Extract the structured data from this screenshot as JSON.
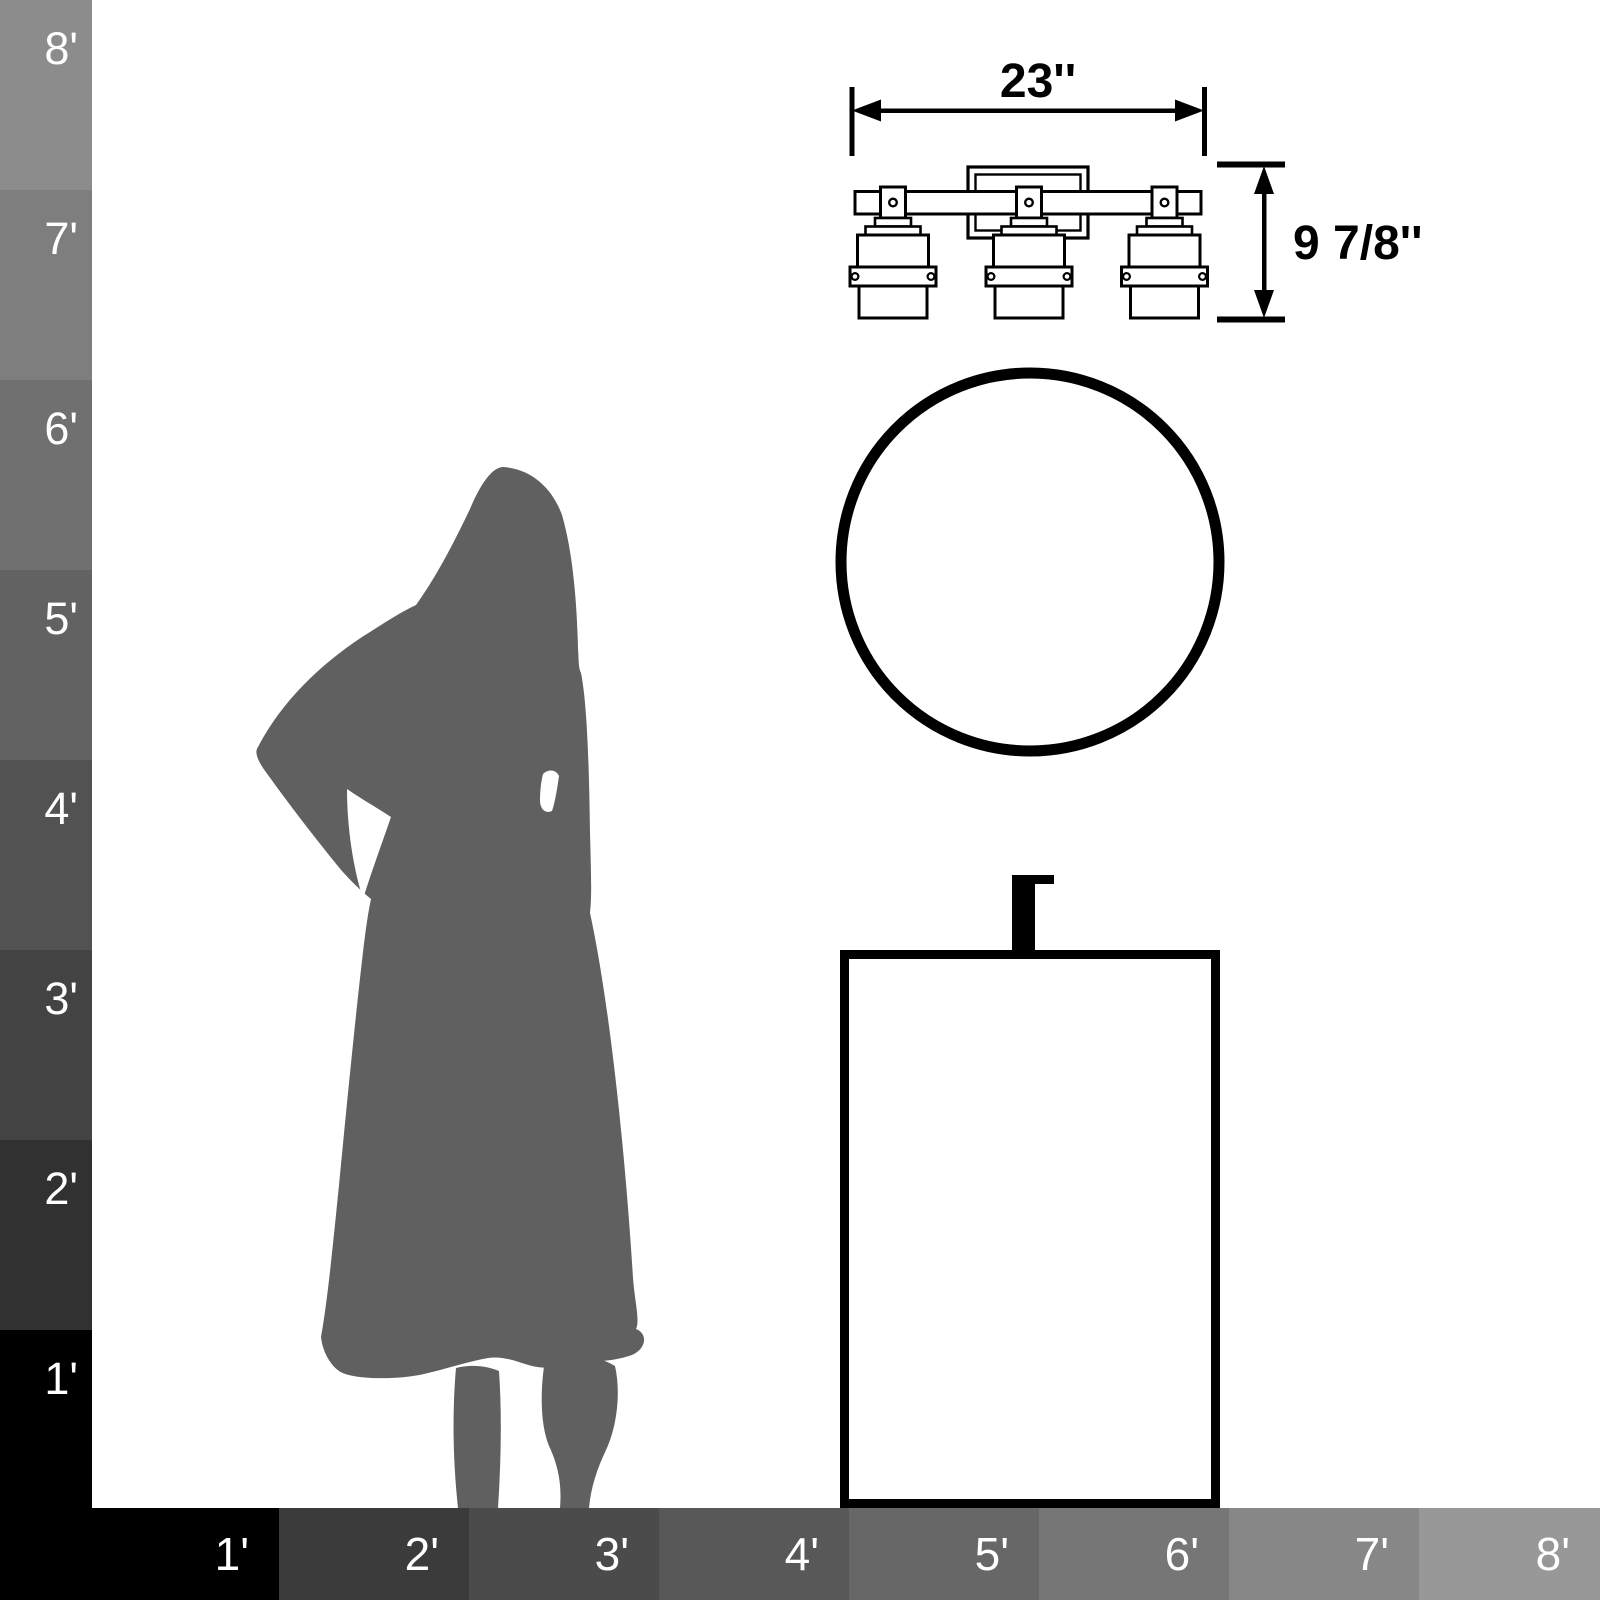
{
  "rulers": {
    "text_color": "#ffffff",
    "vertical": {
      "labels": [
        "8'",
        "7'",
        "6'",
        "5'",
        "4'",
        "3'",
        "2'",
        "1'"
      ],
      "colors": [
        "#8c8c8c",
        "#7e7e7e",
        "#707070",
        "#626262",
        "#525252",
        "#434343",
        "#313131",
        "#000000"
      ]
    },
    "horizontal": {
      "labels": [
        "1'",
        "2'",
        "3'",
        "4'",
        "5'",
        "6'",
        "7'",
        "8'"
      ],
      "colors": [
        "#000000",
        "#3b3b3b",
        "#4b4b4b",
        "#585858",
        "#676767",
        "#767676",
        "#878787",
        "#989898"
      ]
    }
  },
  "drawing": {
    "width_label": "23''",
    "height_label": "9 7/8''",
    "line_color": "#000000",
    "fill_color": "#ffffff"
  },
  "silhouette": {
    "color": "#606060"
  }
}
